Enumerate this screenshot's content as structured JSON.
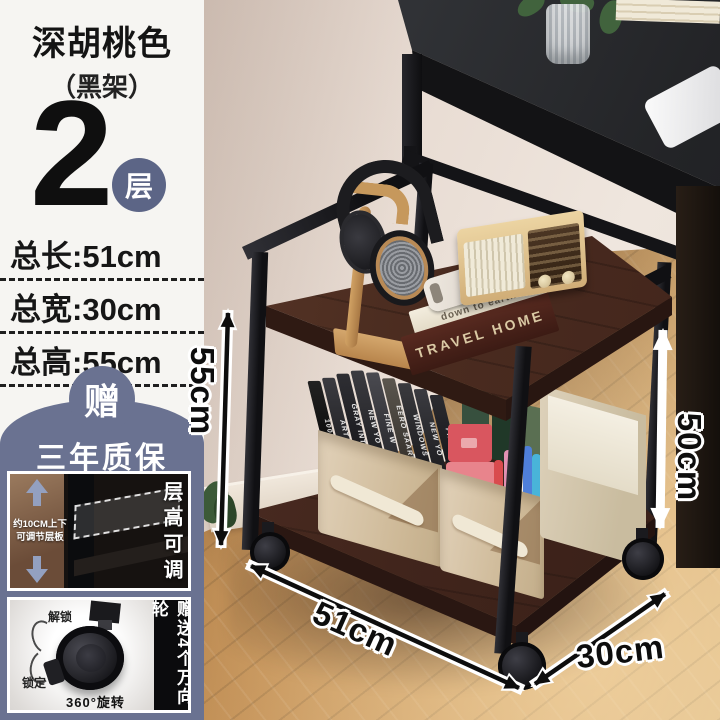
{
  "panel": {
    "title": "深胡桃色",
    "subtitle": "（黑架）",
    "tier_number": "2",
    "tier_unit": "层",
    "specs": [
      "总长:51cm",
      "总宽:30cm",
      "总高:55cm"
    ],
    "gift_badge": "赠",
    "warranty_text": "三年质保",
    "adjust_inset": {
      "note_line1": "约10CM上下",
      "note_line2": "可调节层板",
      "side_label": "层高可调"
    },
    "wheel_inset": {
      "unlock_label": "解锁",
      "lock_label": "锁定",
      "rotate_label": "360°旋转",
      "side_label": "赠送4个万向轮"
    }
  },
  "dimension_labels": {
    "total_height": "55cm",
    "shelf_height": "50cm",
    "length": "51cm",
    "depth": "30cm"
  },
  "scene_text": {
    "book_spine_top": "down to earth",
    "book_spine_bottom": "TRAVEL HOME",
    "magazine_spines": [
      "1000",
      "ART",
      "GRAY INTE",
      "NEW YO",
      "FINE W",
      "EERO SAARI",
      "WINDOWS",
      "NEW YO",
      "FINE W"
    ]
  },
  "colors": {
    "accent_blue": "#6a7291",
    "badge_blue": "#5c6586",
    "panel_bg": "#f6f5f2",
    "wood_shelf": "#4b2c20",
    "frame_black": "#1b1b1e",
    "floor_wood": "#bb8a55",
    "storage_box": "#d9c9af"
  }
}
